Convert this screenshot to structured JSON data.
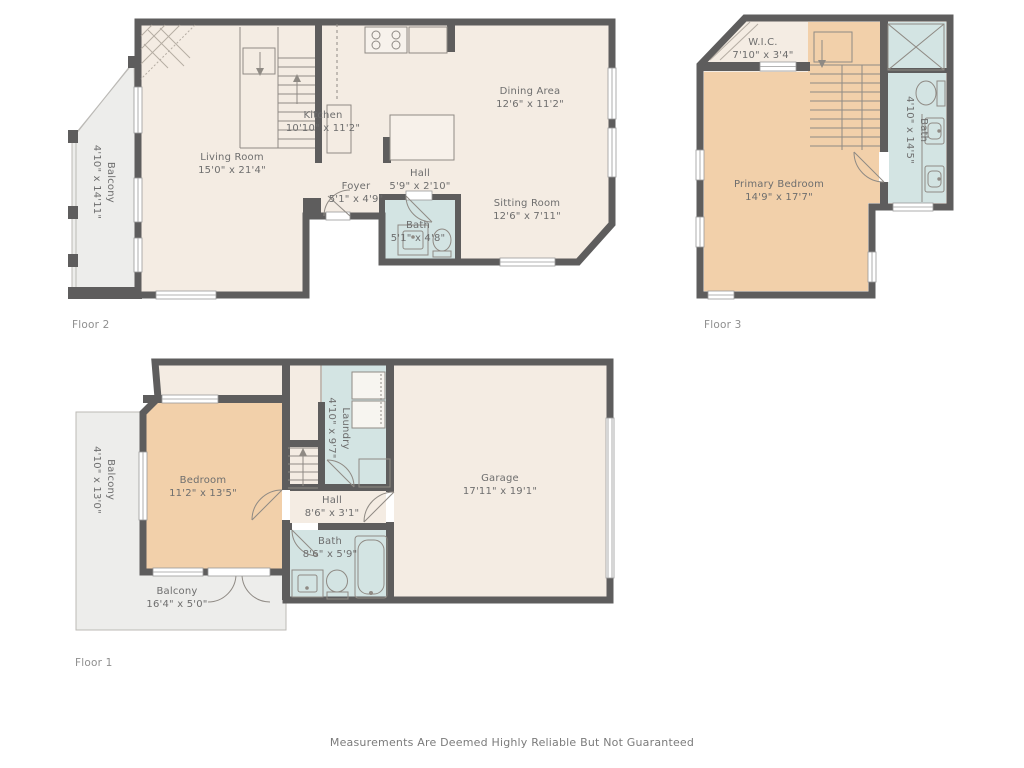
{
  "disclaimer": "Measurements Are Deemed Highly Reliable But Not Guaranteed",
  "colors": {
    "wall": "#5e5d5d",
    "floor_cream": "#f4ece3",
    "bedroom_peach": "#f2d0aa",
    "bath_blue": "#d3e4e3",
    "balcony_gray": "#ededeb",
    "label_text": "#6e6e6e"
  },
  "floors": [
    {
      "label": "Floor 2",
      "rooms": [
        {
          "name": "Balcony",
          "dims": "4'10\" x 14'11\""
        },
        {
          "name": "Living Room",
          "dims": "15'0\" x 21'4\""
        },
        {
          "name": "Kitchen",
          "dims": "10'10\" x 11'2\""
        },
        {
          "name": "Dining Area",
          "dims": "12'6\" x 11'2\""
        },
        {
          "name": "Foyer",
          "dims": "5'1\" x 4'9\""
        },
        {
          "name": "Hall",
          "dims": "5'9\" x 2'10\""
        },
        {
          "name": "Bath",
          "dims": "5'1\" x 4'8\""
        },
        {
          "name": "Sitting Room",
          "dims": "12'6\" x 7'11\""
        }
      ]
    },
    {
      "label": "Floor 3",
      "rooms": [
        {
          "name": "W.I.C.",
          "dims": "7'10\" x 3'4\""
        },
        {
          "name": "Primary Bedroom",
          "dims": "14'9\" x 17'7\""
        },
        {
          "name": "Bath",
          "dims": "4'10\" x 14'5\""
        }
      ]
    },
    {
      "label": "Floor 1",
      "rooms": [
        {
          "name": "Balcony",
          "dims": "4'10\" x 13'0\""
        },
        {
          "name": "Bedroom",
          "dims": "11'2\" x 13'5\""
        },
        {
          "name": "Laundry",
          "dims": "4'10\" x 9'7\""
        },
        {
          "name": "Hall",
          "dims": "8'6\" x 3'1\""
        },
        {
          "name": "Garage",
          "dims": "17'11\" x 19'1\""
        },
        {
          "name": "Bath",
          "dims": "8'6\" x 5'9\""
        },
        {
          "name": "Balcony",
          "dims": "16'4\" x 5'0\""
        }
      ]
    }
  ]
}
